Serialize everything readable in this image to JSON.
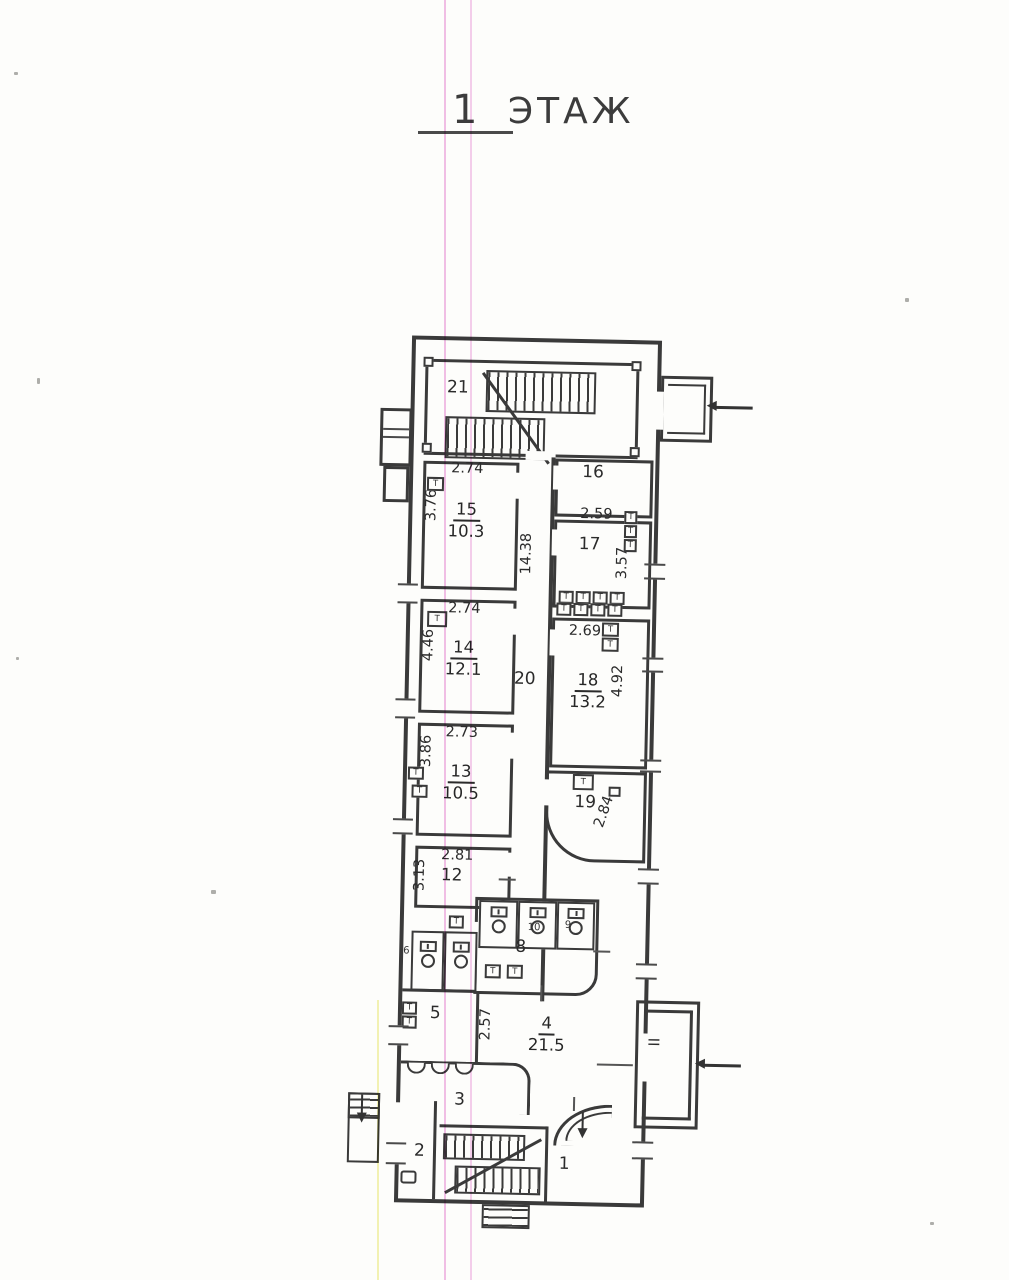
{
  "title": {
    "number": "1",
    "word": "ЭТАЖ"
  },
  "symbols": {
    "radiator": "Т"
  },
  "rooms": {
    "r1": {
      "num": "1"
    },
    "r2": {
      "num": "2"
    },
    "r3": {
      "num": "3"
    },
    "r4": {
      "num": "4",
      "area": "21.5"
    },
    "r5": {
      "num": "5"
    },
    "r6": {
      "num": "6"
    },
    "r8": {
      "num": "8"
    },
    "r9": {
      "num": "9"
    },
    "r10": {
      "num": "10"
    },
    "r12": {
      "num": "12"
    },
    "r13": {
      "num": "13",
      "area": "10.5"
    },
    "r14": {
      "num": "14",
      "area": "12.1"
    },
    "r15": {
      "num": "15",
      "area": "10.3"
    },
    "r16": {
      "num": "16"
    },
    "r17": {
      "num": "17"
    },
    "r18": {
      "num": "18",
      "area": "13.2"
    },
    "r19": {
      "num": "19"
    },
    "r20": {
      "num": "20"
    },
    "r21": {
      "num": "21"
    },
    "porch2": {
      "num": "II"
    }
  },
  "dims": {
    "r15_w": "2.74",
    "r15_h": "3.76",
    "r14_w": "2.74",
    "r14_h": "4.46",
    "r13_w": "2.73",
    "r13_h": "3.86",
    "r12_w": "2.81",
    "r12_h": "3.13",
    "r17_w": "2.59",
    "r17_h": "3.57",
    "r18_w": "2.69",
    "r18_h": "4.92",
    "r19_h": "2.84",
    "r20_len": "14.38",
    "r4_w": "2.57"
  },
  "colors": {
    "ink": "#3a3a3a",
    "registration_pink": "#e78cd6",
    "registration_yellow": "#f0ee96"
  }
}
